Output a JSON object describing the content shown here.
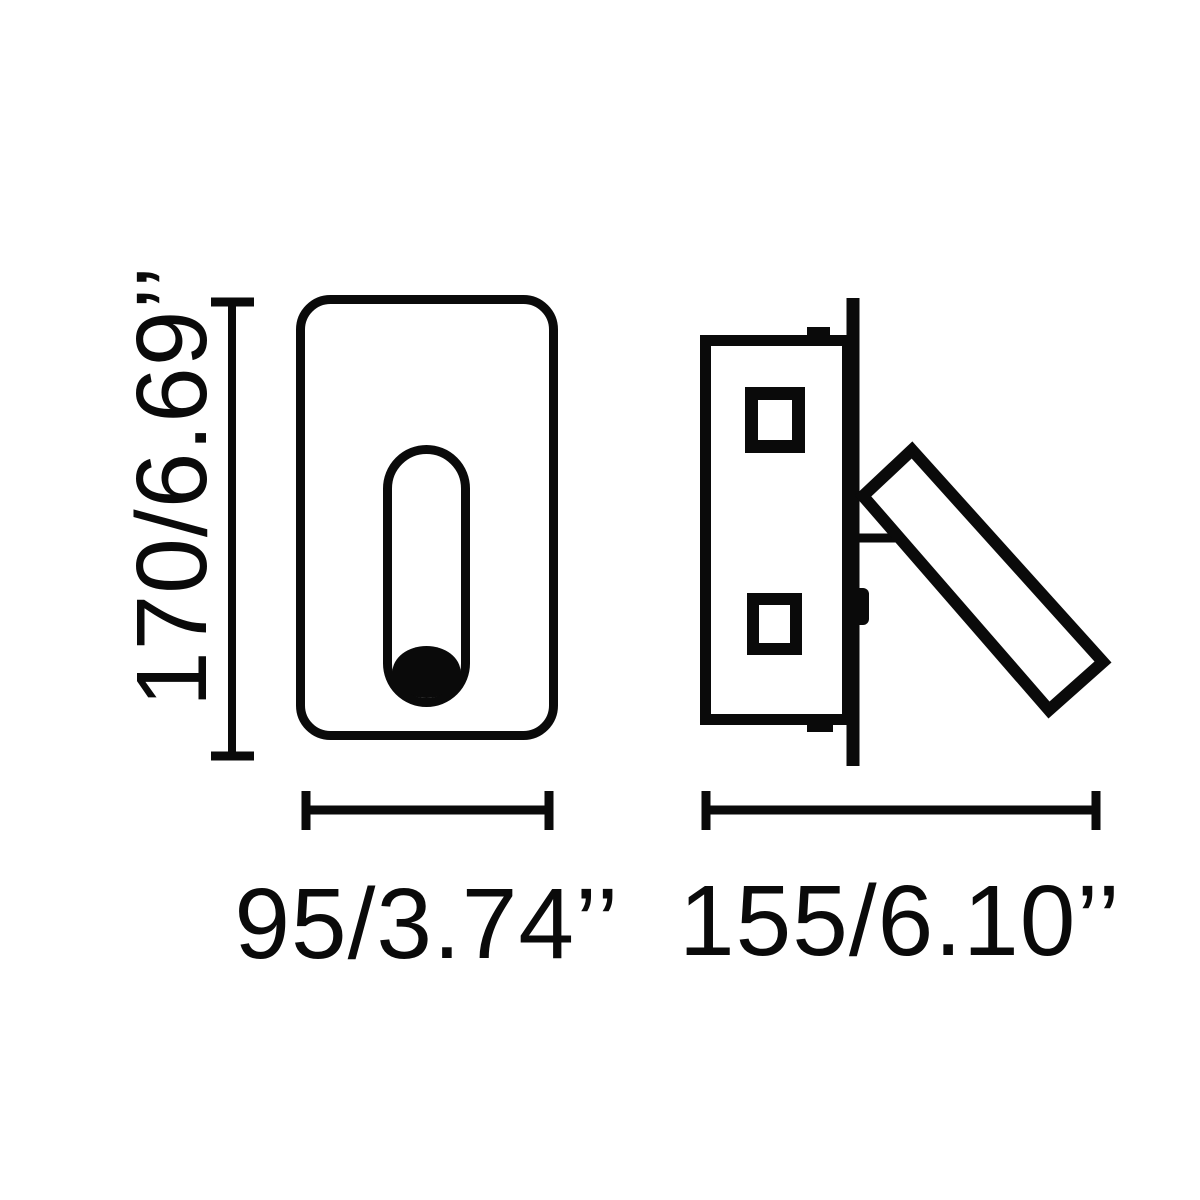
{
  "diagram": {
    "kind": "product-dimension-drawing",
    "views": [
      {
        "id": "front-view"
      },
      {
        "id": "side-view"
      }
    ]
  },
  "dimensions": {
    "height": {
      "label": "170/6.69’’",
      "mm": "170",
      "inches": "6.69"
    },
    "width": {
      "label": "95/3.74’’",
      "mm": "95",
      "inches": "3.74"
    },
    "depth": {
      "label": "155/6.10’’",
      "mm": "155",
      "inches": "6.10"
    }
  },
  "colors": {
    "ink": "#0a0a0a",
    "background": "#ffffff"
  }
}
